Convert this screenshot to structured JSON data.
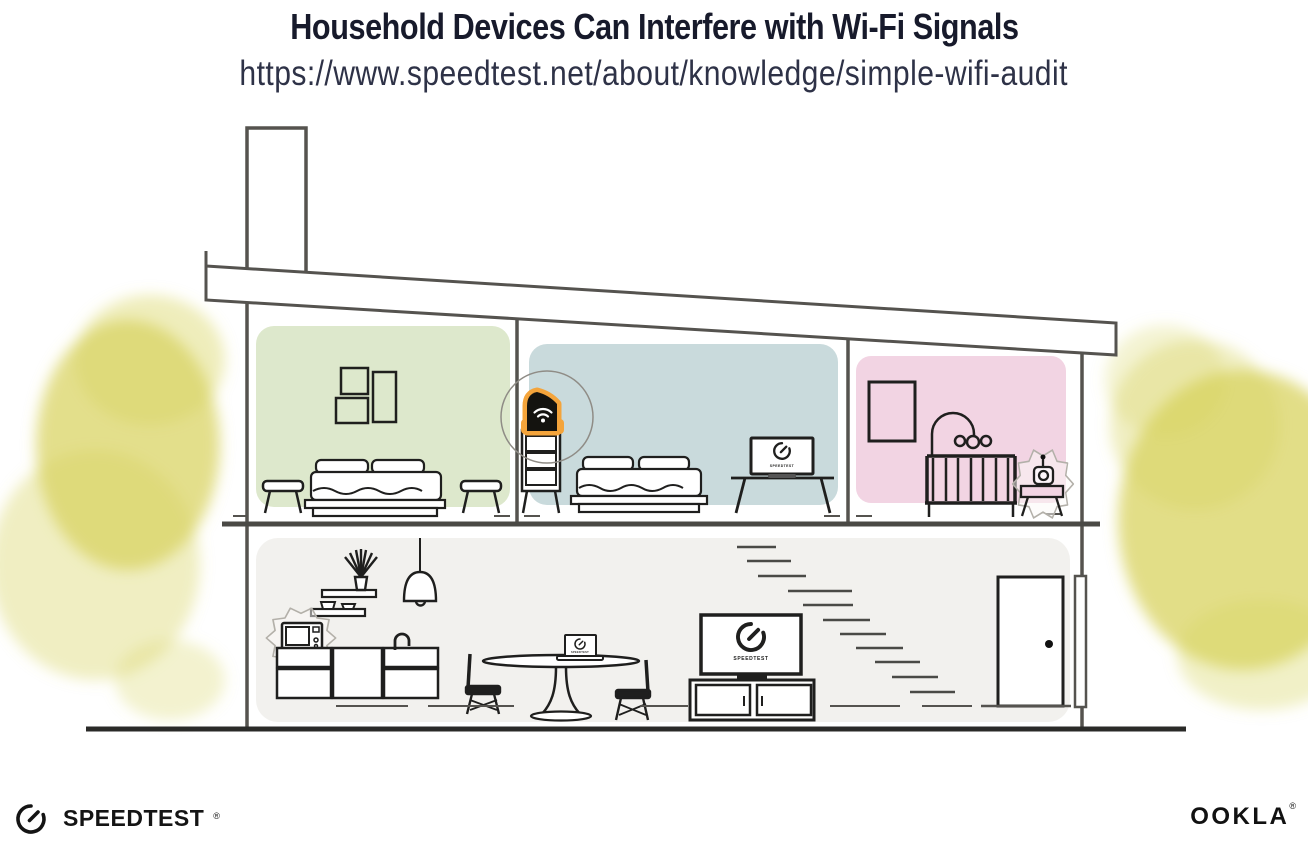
{
  "header": {
    "title": "Household Devices Can Interfere with Wi-Fi Signals",
    "url": "https://www.speedtest.net/about/knowledge/simple-wifi-audit"
  },
  "devices": {
    "tv_label": "SPEEDTEST",
    "bedroom_laptop_label": "SPEEDTEST",
    "dining_laptop_label": "SPEEDTEST"
  },
  "branding": {
    "speedtest": "SPEEDTEST",
    "speedtest_reg": "®",
    "ookla": "OOKLA",
    "ookla_reg": "®"
  },
  "colors": {
    "accent_orange": "#F4A43B",
    "green_room": "#DDE8CC",
    "blue_room": "#C9DADC",
    "pink_room": "#F2D4E3",
    "lower_floor": "#F2F1EE",
    "foliage_yellow": "#D8D35F",
    "title_text": "#171A2B",
    "structure_line": "#55534F",
    "furniture_line": "#1F1F1E"
  }
}
